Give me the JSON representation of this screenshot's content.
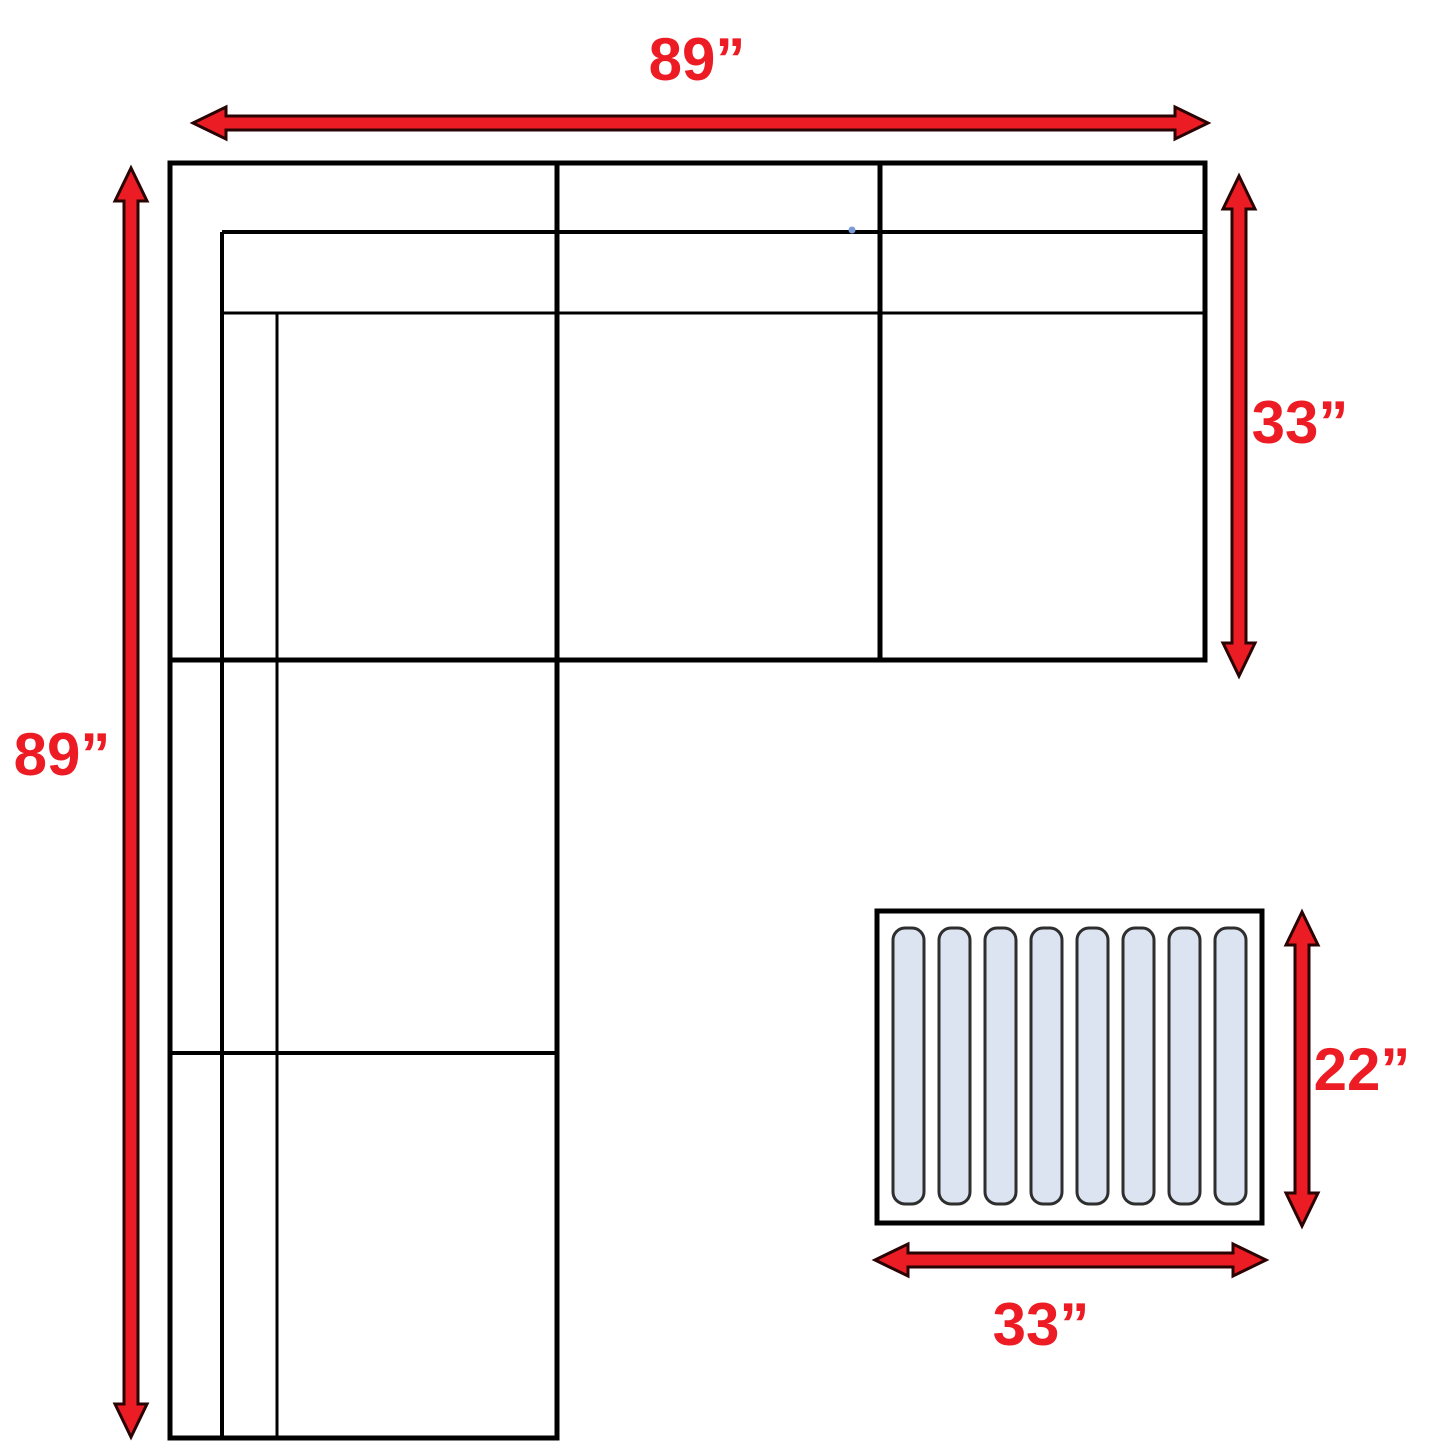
{
  "dimensions": {
    "sofa_width_label": "89”",
    "sofa_height_label": "89”",
    "sofa_depth_label": "33”",
    "ottoman_height_label": "22”",
    "ottoman_width_label": "33”"
  },
  "ottoman": {
    "slat_count": 8
  },
  "colors": {
    "arrow_fill": "#ec1c24",
    "arrow_outline": "#2a0303",
    "label_text": "#ed1c24",
    "line_black": "#000000",
    "slat_fill": "#dce4f1",
    "slat_stroke": "#2e2e2e"
  }
}
